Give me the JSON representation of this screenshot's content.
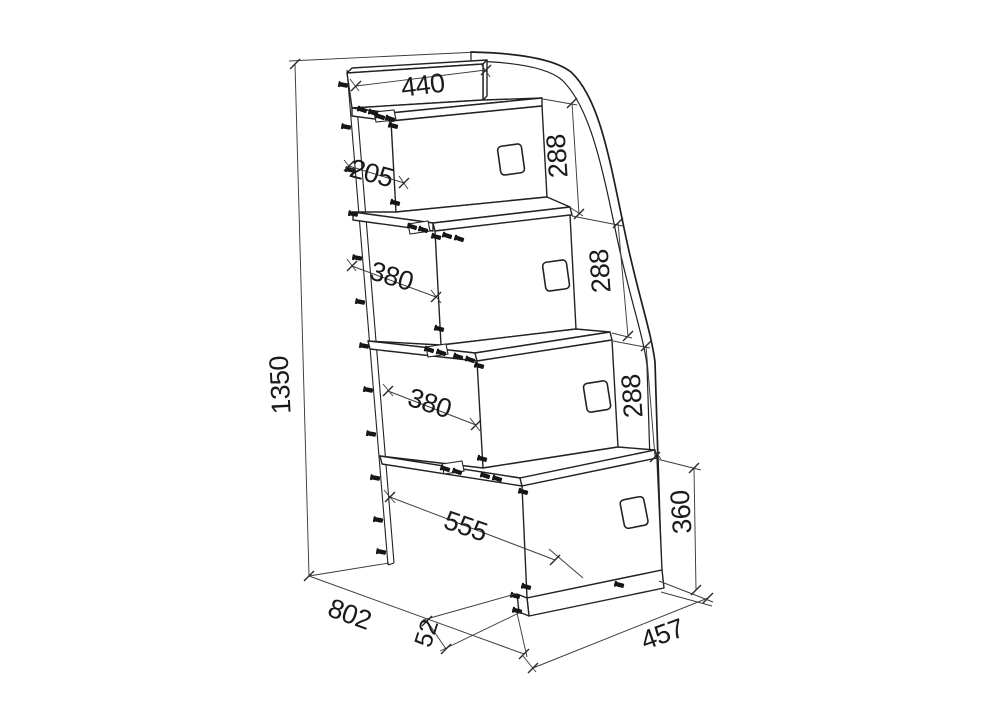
{
  "diagram": {
    "type": "furniture-step-ladder-technical-drawing",
    "background": "#ffffff",
    "line_color": "#232323",
    "dim_line_color": "#3c3c3c",
    "text_color": "#1a1a1a",
    "dims": {
      "total_height": "1350",
      "footprint_depth": "802",
      "footprint_width": "457",
      "top_rail_length": "440",
      "top_step_depth": "205",
      "rise_1": "288",
      "rise_2": "288",
      "rise_3": "288",
      "step_depth_a": "380",
      "step_depth_b": "380",
      "bottom_box_depth": "555",
      "bottom_box_height": "360",
      "plinth_height": "52"
    }
  }
}
